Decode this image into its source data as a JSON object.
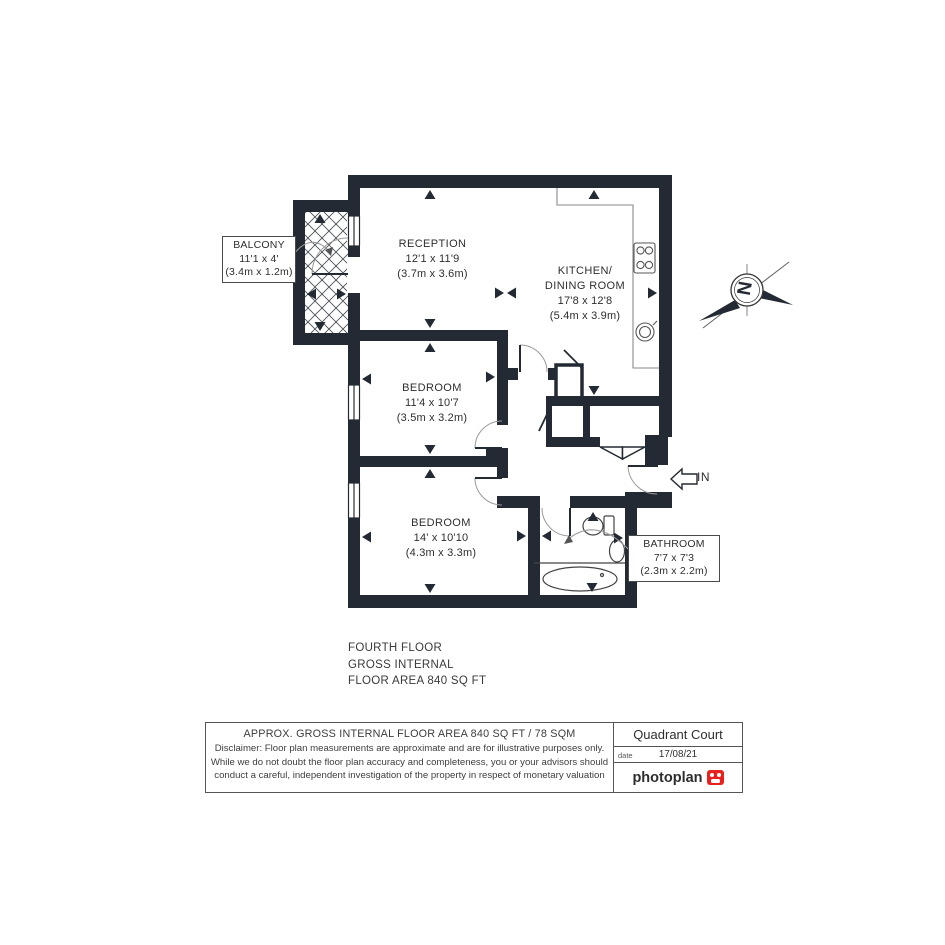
{
  "plan": {
    "rooms": {
      "reception": {
        "name": "RECEPTION",
        "imperial": "12'1 x 11'9",
        "metric": "(3.7m x 3.6m)"
      },
      "kitchen": {
        "name_line1": "KITCHEN/",
        "name_line2": "DINING ROOM",
        "imperial": "17'8 x 12'8",
        "metric": "(5.4m x 3.9m)"
      },
      "bedroom1": {
        "name": "BEDROOM",
        "imperial": "11'4 x 10'7",
        "metric": "(3.5m x 3.2m)"
      },
      "bedroom2": {
        "name": "BEDROOM",
        "imperial": "14' x 10'10",
        "metric": "(4.3m x 3.3m)"
      },
      "balcony": {
        "name": "BALCONY",
        "imperial": "11'1 x 4'",
        "metric": "(3.4m x 1.2m)"
      },
      "bathroom": {
        "name": "BATHROOM",
        "imperial": "7'7 x 7'3",
        "metric": "(2.3m x 2.2m)"
      }
    },
    "entrance_label": "IN",
    "compass_letter": "N"
  },
  "floor_summary": {
    "line1": "FOURTH FLOOR",
    "line2": "GROSS INTERNAL",
    "line3": "FLOOR AREA 840 SQ FT"
  },
  "footer": {
    "area_title": "APPROX. GROSS INTERNAL FLOOR AREA 840 SQ FT / 78 SQM",
    "disclaimer_line1": "Disclaimer: Floor plan measurements are approximate and are for illustrative purposes only.",
    "disclaimer_line2": "While we do not doubt the floor plan accuracy and completeness, you or your advisors should",
    "disclaimer_line3": "conduct a careful, independent investigation of the property in respect of monetary valuation",
    "property_name": "Quadrant Court",
    "date_label": "date",
    "date_value": "17/08/21",
    "brand": "photoplan"
  },
  "colors": {
    "wall": "#242a33",
    "brand_red": "#e8211d"
  }
}
